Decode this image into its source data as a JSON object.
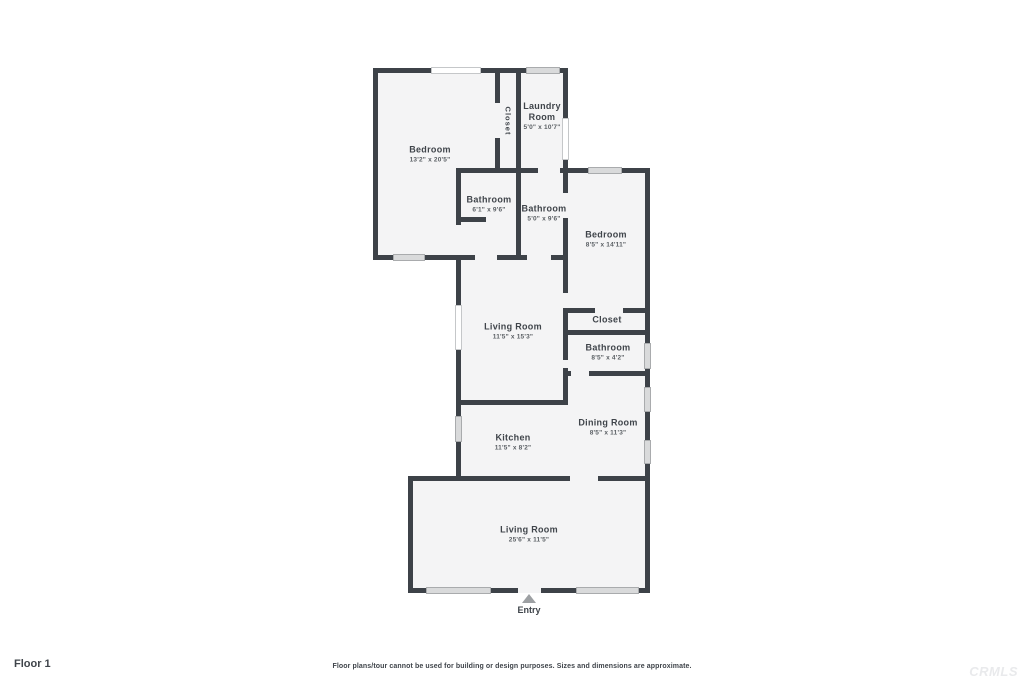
{
  "page": {
    "floor_label": "Floor 1",
    "entry_label": "Entry",
    "disclaimer": "Floor plans/tour cannot be used for building or design purposes. Sizes and dimensions are approximate.",
    "watermark": "CRMLS"
  },
  "colors": {
    "wall": "#3d4248",
    "room_fill": "#f4f4f5",
    "window_fill": "#d9dadb",
    "window_border": "#a9abad",
    "label_text": "#3f444a",
    "entry_arrow": "#9da0a3",
    "watermark_text": "#e9eaec"
  },
  "rooms": [
    {
      "name": "Bedroom",
      "dims": "13'2\" x 20'5\""
    },
    {
      "name": "Closet",
      "dims": ""
    },
    {
      "name": "Laundry Room",
      "dims": "5'0\" x 10'7\""
    },
    {
      "name": "Bathroom",
      "dims": "6'1\" x 9'6\""
    },
    {
      "name": "Bathroom",
      "dims": "5'0\" x 9'6\""
    },
    {
      "name": "Bedroom",
      "dims": "8'5\" x 14'11\""
    },
    {
      "name": "Closet",
      "dims": ""
    },
    {
      "name": "Bathroom",
      "dims": "8'5\" x 4'2\""
    },
    {
      "name": "Living Room",
      "dims": "11'5\" x 15'3\""
    },
    {
      "name": "Kitchen",
      "dims": "11'5\" x 8'2\""
    },
    {
      "name": "Dining Room",
      "dims": "8'5\" x 11'3\""
    },
    {
      "name": "Living Room",
      "dims": "25'6\" x 11'5\""
    }
  ]
}
